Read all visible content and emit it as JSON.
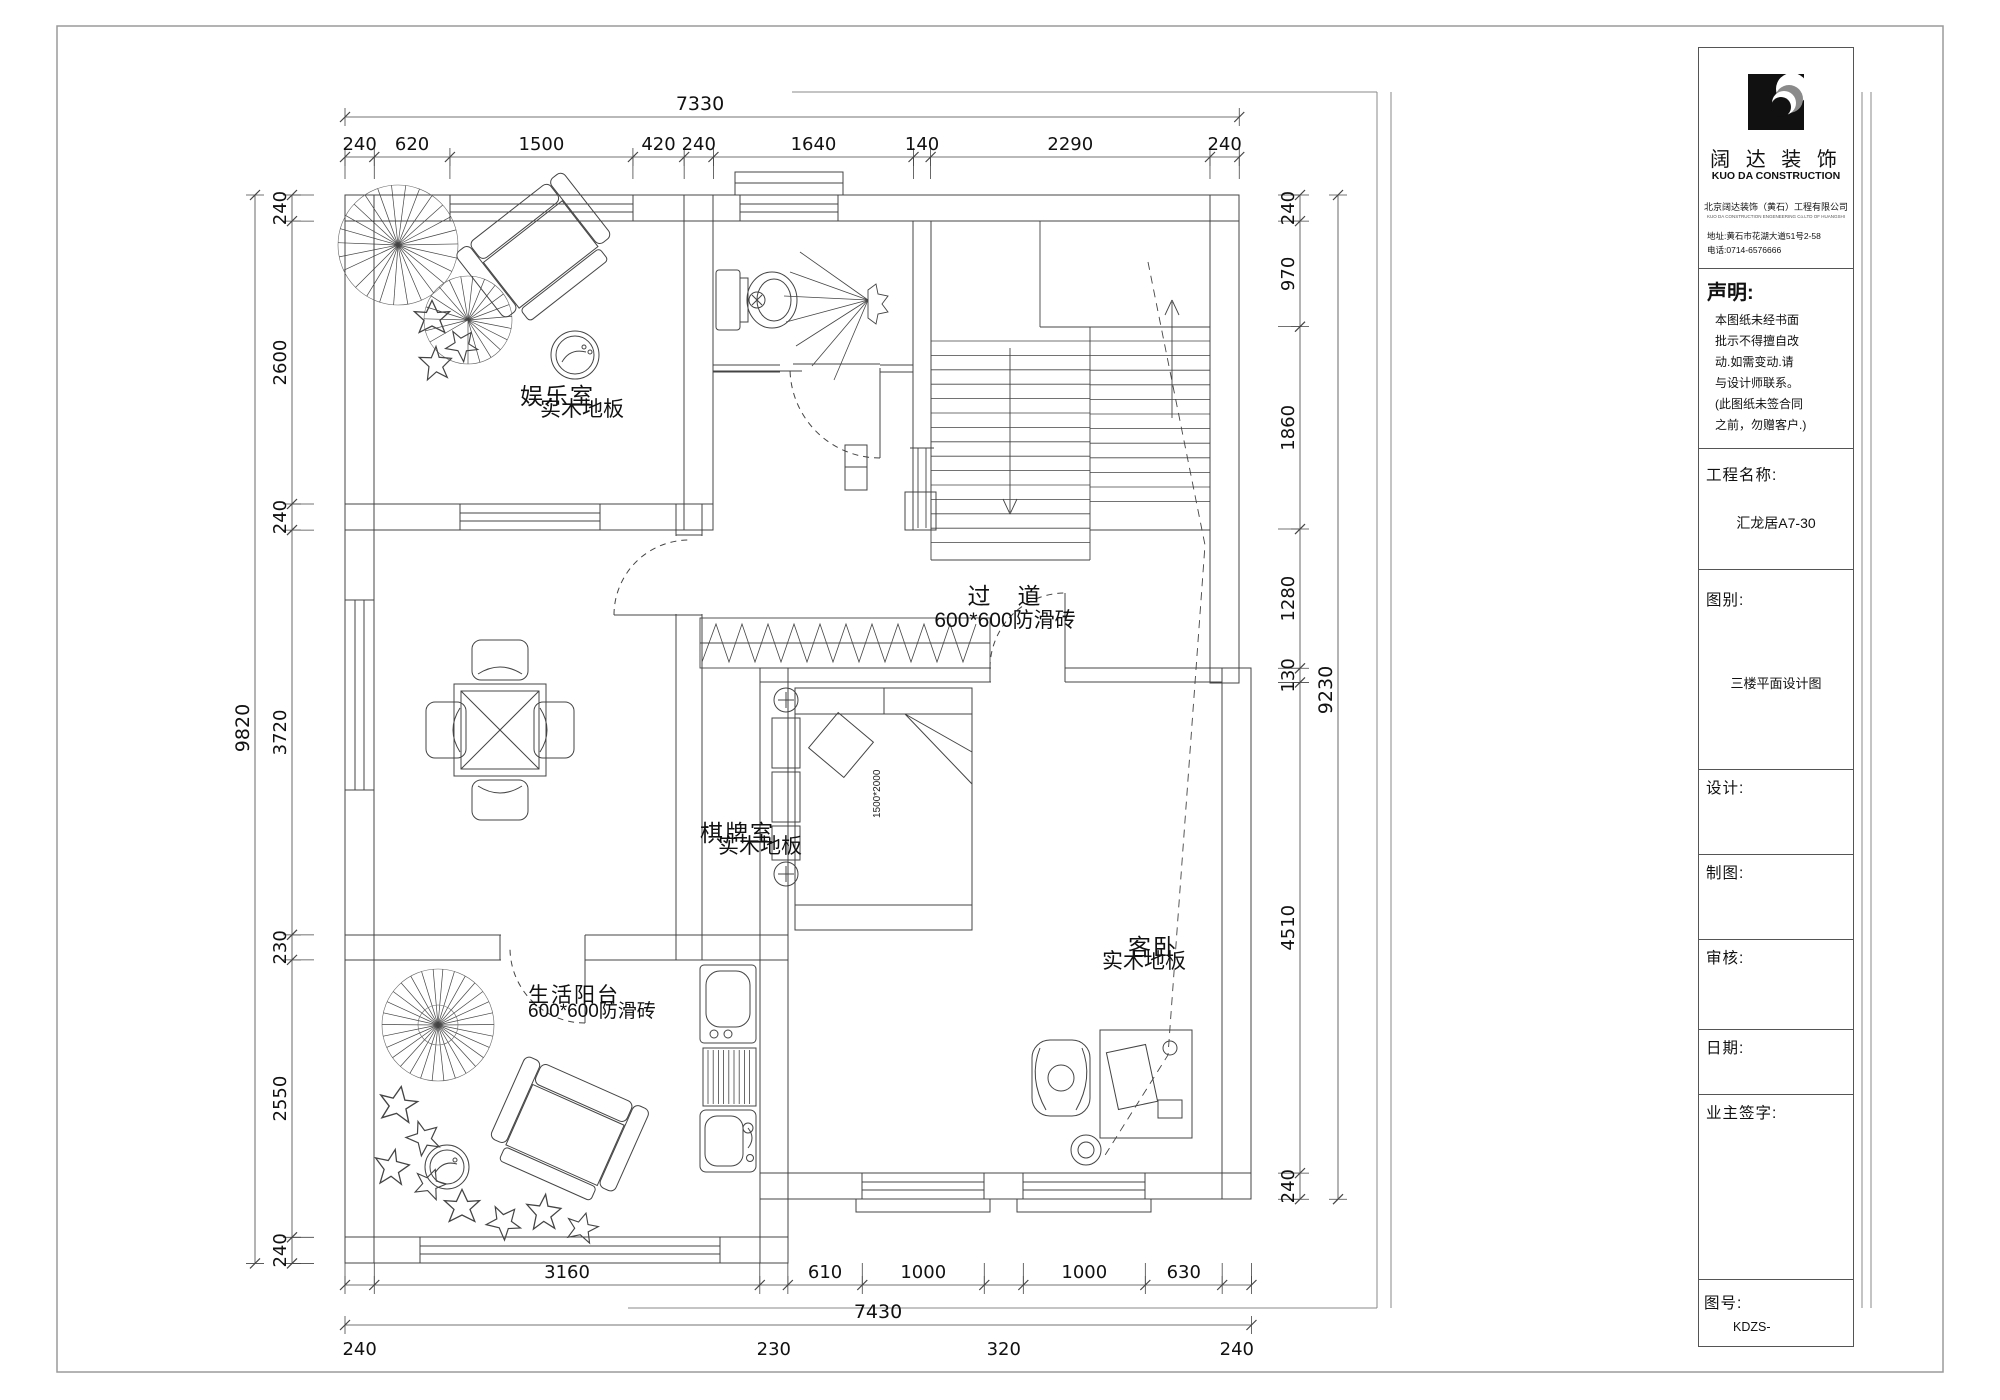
{
  "title_block": {
    "logo_text": "阔 达 装 饰",
    "logo_subtext": "KUO DA CONSTRUCTION",
    "company": "北京阔达装饰（黄石）工程有限公司",
    "company_en": "KUO DA CONSTRUCTION ENGENEERING Co.LTD OF HUANGSHI",
    "address": "地址:黄石市花湖大道51号2-58",
    "phone": "电话:0714-6576666",
    "statement_label": "声明:",
    "statement_lines": [
      "本图纸未经书面",
      "批示不得擅自改",
      "动.如需变动.请",
      "与设计师联系。",
      "(此图纸未签合同",
      "之前，勿赠客户.)"
    ],
    "project_label": "工程名称:",
    "project_value": "汇龙居A7-30",
    "category_label": "图别:",
    "category_value": "三楼平面设计图",
    "design_label": "设计:",
    "draft_label": "制图:",
    "review_label": "审核:",
    "date_label": "日期:",
    "owner_label": "业主签字:",
    "number_label": "图号:",
    "number_value": "KDZS-"
  },
  "rooms": [
    {
      "name": "娱乐室",
      "sub": "实木地板"
    },
    {
      "name": "过　道",
      "sub": "600*600防滑砖"
    },
    {
      "name": "棋牌室",
      "sub": "实木地板"
    },
    {
      "name": "生活阳台",
      "sub": "600*600防滑砖"
    },
    {
      "name": "客卧",
      "sub": "实木地板"
    }
  ],
  "bed_label": "1500*2000",
  "dimensions": {
    "top": {
      "total": 7330,
      "chain": [
        240,
        620,
        1500,
        420,
        240,
        1640,
        140,
        2290,
        240
      ]
    },
    "bottom": {
      "total": 7430,
      "chain": [
        240,
        3160,
        230,
        610,
        1000,
        320,
        1000,
        630,
        240
      ],
      "below": [
        1,
        0,
        1,
        0,
        0,
        1,
        0,
        0,
        1
      ]
    },
    "left": {
      "total": 9820,
      "chain": [
        240,
        2600,
        240,
        3720,
        230,
        2550,
        240
      ]
    },
    "right": {
      "total": 9230,
      "chain": [
        240,
        970,
        1860,
        1280,
        130,
        4510,
        240
      ]
    }
  }
}
